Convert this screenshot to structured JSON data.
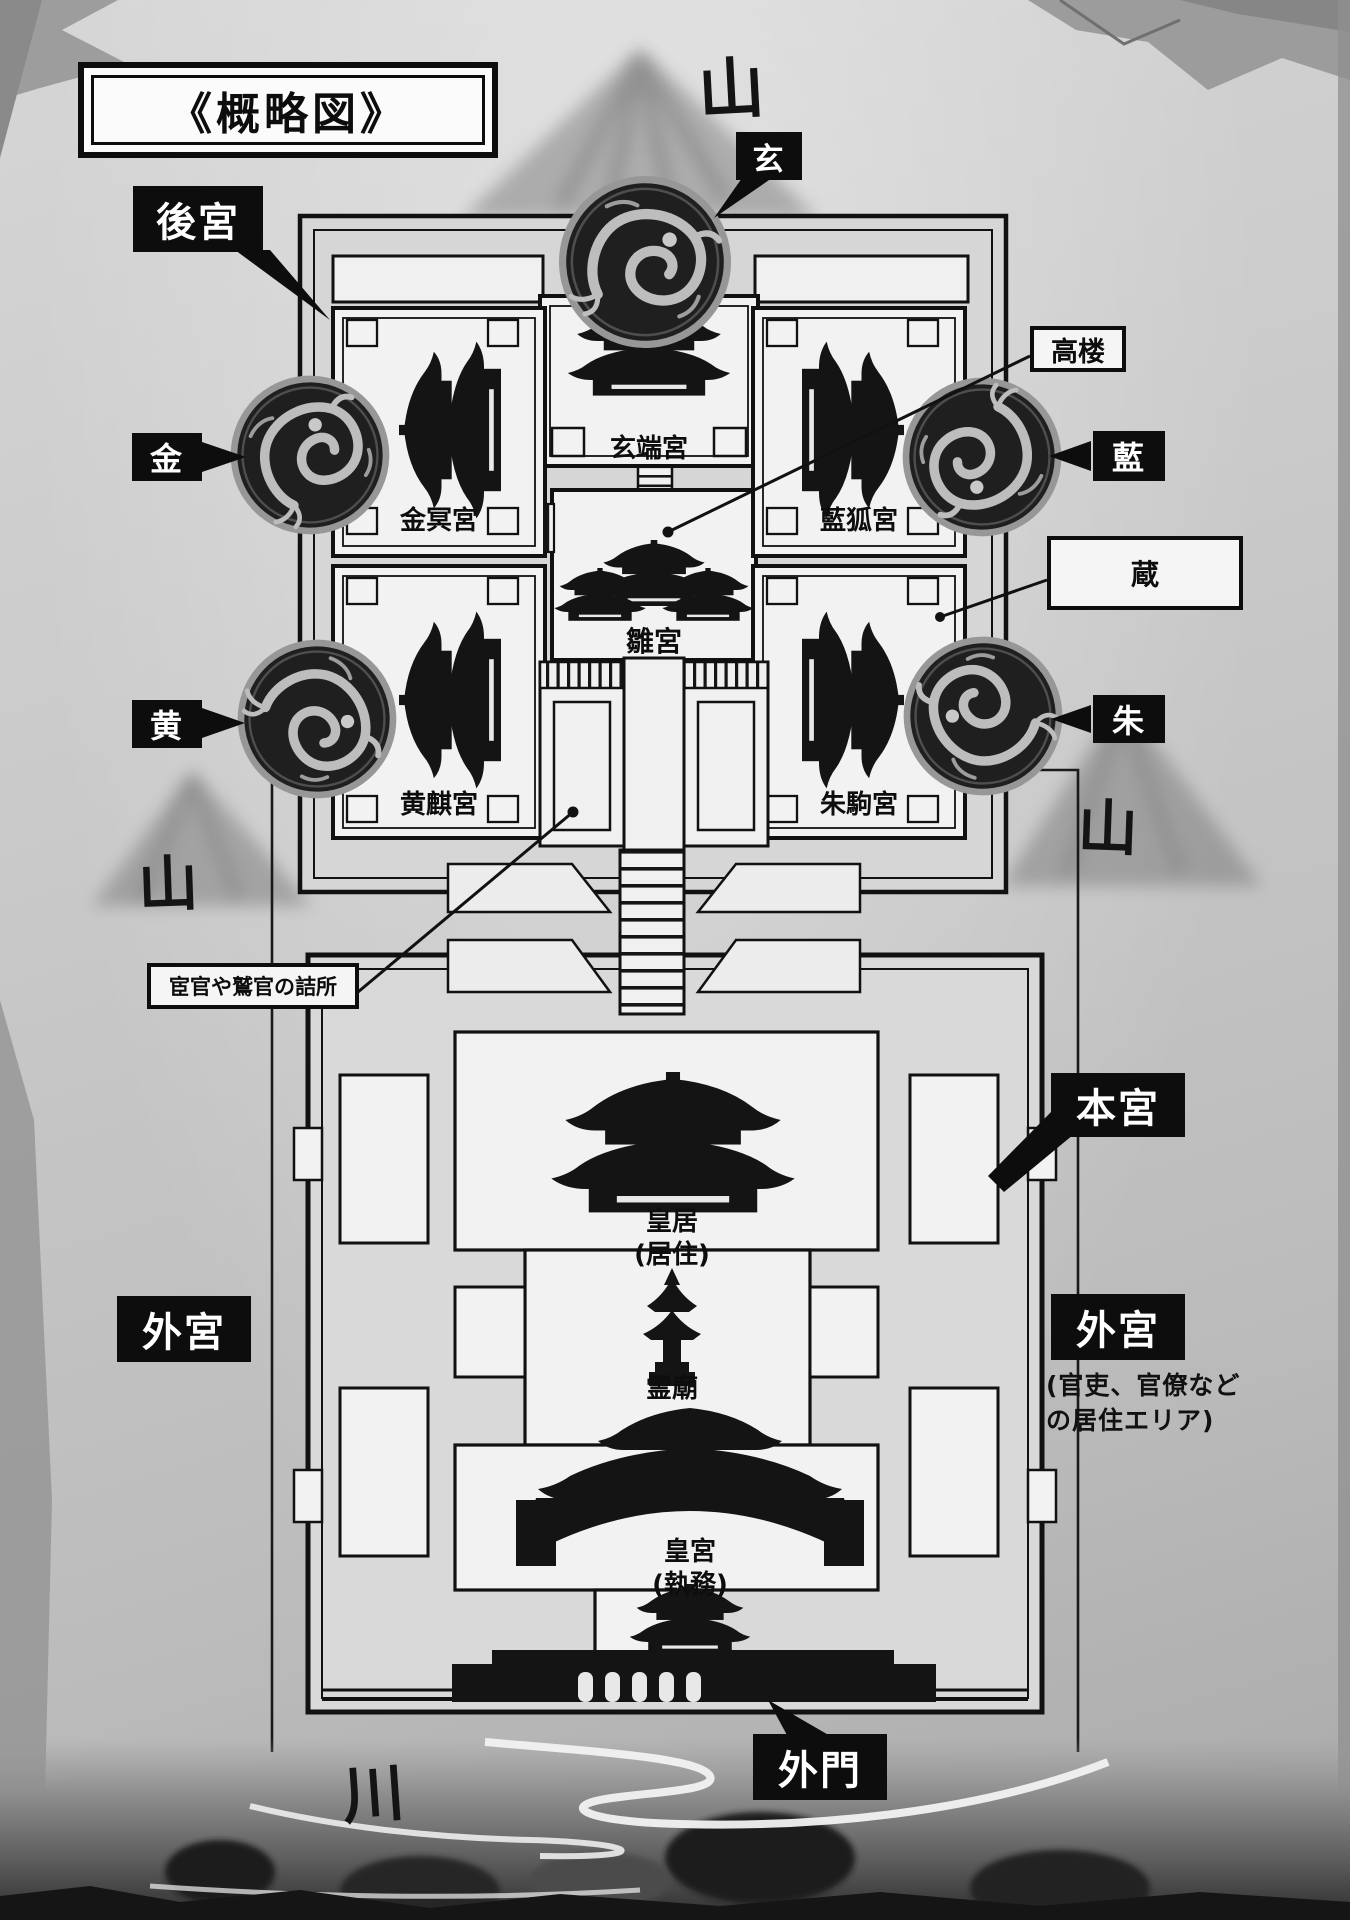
{
  "title": "《概略図》",
  "nature": {
    "mountain_top": "山",
    "mountain_left": "山",
    "mountain_right": "山",
    "river": "川"
  },
  "medallions": {
    "gen": "玄",
    "kin": "金",
    "ran": "藍",
    "ou": "黄",
    "shu": "朱"
  },
  "areas": {
    "koukyuu": "後宮",
    "hongu": "本宮",
    "gekyuu_left": "外宮",
    "gekyuu_right": "外宮",
    "gekyuu_note_line1": "(官吏、官僚など",
    "gekyuu_note_line2": "の居住エリア)",
    "gaimon": "外門"
  },
  "callouts": {
    "kourou": "高楼",
    "kura": "蔵",
    "tsumesho": "宦官や鷲官の詰所"
  },
  "palaces": {
    "gentankyuu": "玄端宮",
    "kinmeikyuu": "金冥宮",
    "rankokyuu": "藍狐宮",
    "oukikyuu": "黄麒宮",
    "shukukyuu": "朱駒宮",
    "hinakyuu": "雛宮"
  },
  "buildings": {
    "koukyo": "皇居",
    "koukyo_note": "(居住)",
    "reibyou": "霊廟",
    "kouguu": "皇宮",
    "kouguu_note": "(執務)"
  },
  "colors": {
    "ink": "#111111",
    "paper": "#c8c8c8",
    "courtyard_white": "#f2f2f2",
    "label_black_bg": "#0d0d0d",
    "label_white_fg": "#ffffff"
  }
}
